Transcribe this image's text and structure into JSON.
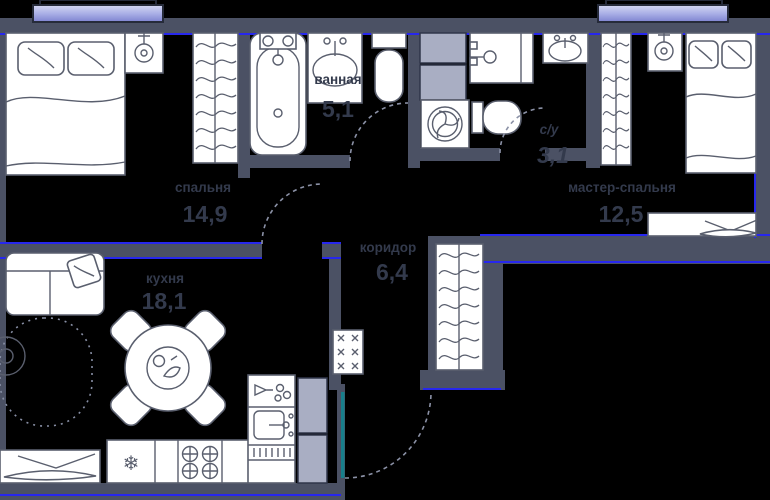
{
  "plan": {
    "rooms": [
      {
        "id": "bedroom",
        "name": "спальня",
        "area": "14,9"
      },
      {
        "id": "bathroom",
        "name": "ванная",
        "area": "5,1"
      },
      {
        "id": "wc",
        "name": "с/у",
        "area": "3,1"
      },
      {
        "id": "master-bedroom",
        "name": "мастер-спальня",
        "area": "12,5"
      },
      {
        "id": "corridor",
        "name": "коридор",
        "area": "6,4"
      },
      {
        "id": "kitchen",
        "name": "кухня",
        "area": "18,1"
      }
    ],
    "icons": {
      "fridge_snowflake": "❄"
    },
    "colors": {
      "background": "#000000",
      "wall": "#4b5164",
      "accent_line": "#2727ee",
      "furniture_stroke": "#5a5f6e",
      "floor_fill": "#ffffff",
      "cabinet_fill": "#a9aec3",
      "window_light": "#d5d8f3",
      "window_mid": "#aab0e6",
      "window_dark": "#7e83d0",
      "entry_door": "#177f8b",
      "arc_dash": "#8b91a6",
      "label_text": "#333a4c"
    }
  }
}
